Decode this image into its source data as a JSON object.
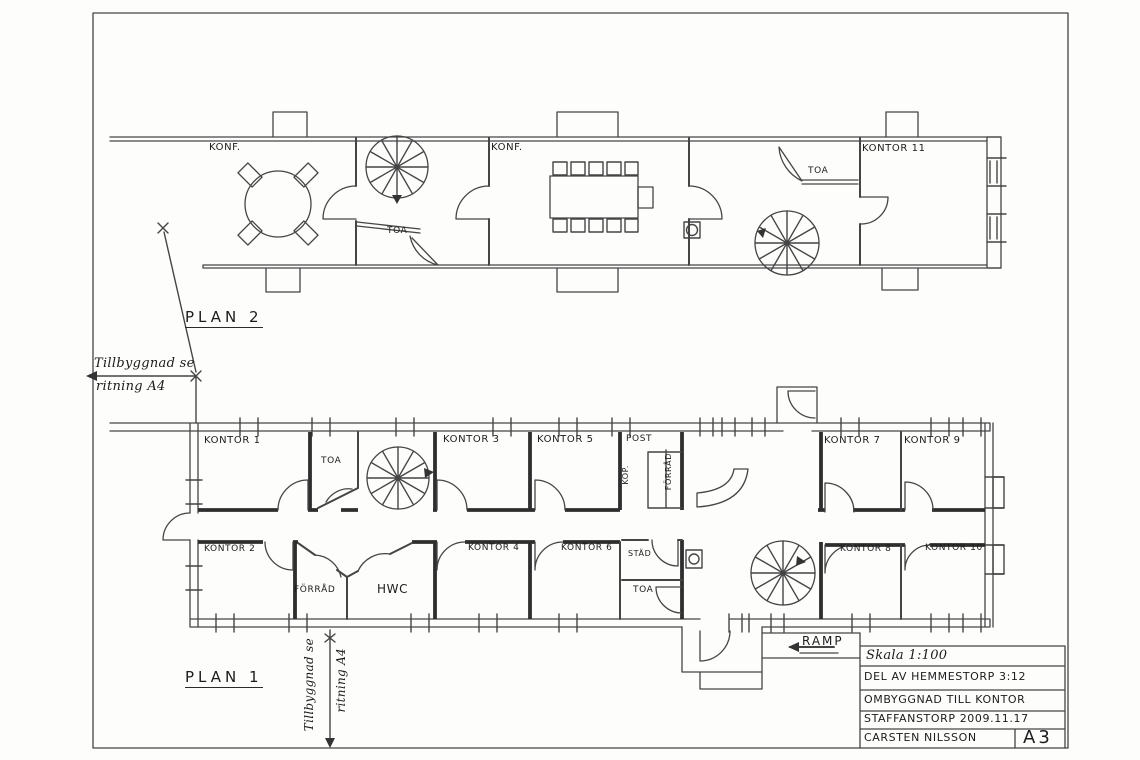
{
  "colors": {
    "ink": "#3f3f3f",
    "wall_dark": "#2e2e2e",
    "paper": "#fdfdfc"
  },
  "plan2": {
    "title": "PLAN 2",
    "labels": {
      "konf_left": "KONF.",
      "toa_left": "TOA",
      "konf_mid": "KONF.",
      "toa_right": "TOA",
      "kontor11": "KONTOR 11"
    }
  },
  "plan1": {
    "title": "PLAN 1",
    "labels": {
      "kontor1": "KONTOR 1",
      "kontor2": "KONTOR 2",
      "kontor3": "KONTOR 3",
      "kontor4": "KONTOR 4",
      "kontor5": "KONTOR 5",
      "kontor6": "KONTOR 6",
      "kontor7": "KONTOR 7",
      "kontor8": "KONTOR 8",
      "kontor9": "KONTOR 9",
      "kontor10": "KONTOR 10",
      "toa_upper": "TOA",
      "toa_lower": "TOA",
      "stad": "STÄD",
      "hwc": "HWC",
      "post": "POST",
      "kop": "KOP.",
      "forrad_upper": "FÖRRÅD",
      "forrad_lower": "FÖRRÅD"
    }
  },
  "annotations": {
    "ramp": "RAMP",
    "extension_left": {
      "line1": "Tillbyggnad se",
      "line2": "ritning A4"
    },
    "extension_bottom": {
      "line1": "Tillbyggnad se",
      "line2": "ritning A4"
    }
  },
  "title_block": {
    "scale": "Skala 1:100",
    "property": "DEL AV HEMMESTORP 3:12",
    "project": "OMBYGGNAD TILL KONTOR",
    "place_date": "STAFFANSTORP 2009.11.17",
    "author": "CARSTEN NILSSON",
    "sheet_format": "A3"
  }
}
